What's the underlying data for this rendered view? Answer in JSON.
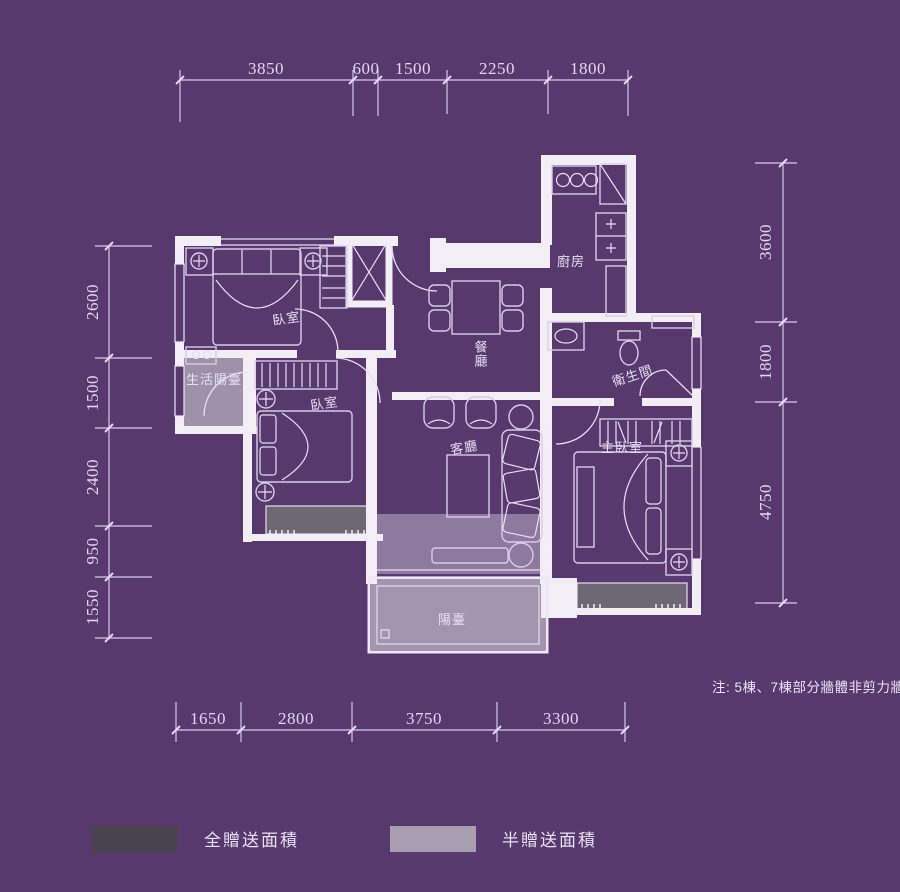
{
  "title": "apartment-floor-plan",
  "colors": {
    "background": "#57396e",
    "wall": "#f3eef6",
    "half_gift_fill": "#a89db1",
    "full_gift_fill": "#6e6874",
    "living_overlay": "rgba(198,188,208,0.5)",
    "dim_line": "#c3b2d8",
    "dim_text": "#e2d6f0"
  },
  "dimensions": {
    "top": [
      "3850",
      "600",
      "1500",
      "2250",
      "1800"
    ],
    "left": [
      "2600",
      "1500",
      "2400",
      "950",
      "1550"
    ],
    "right": [
      "3600",
      "1800",
      "4750"
    ],
    "bottom": [
      "1650",
      "2800",
      "3750",
      "3300"
    ]
  },
  "rooms": {
    "bedroom1": "臥室",
    "bedroom2": "臥室",
    "master_bedroom": "主臥室",
    "living_room": "客廳",
    "dining_room": "餐廳",
    "kitchen": "廚房",
    "bathroom": "衛生間",
    "service_balcony": "生活陽臺",
    "balcony": "陽臺"
  },
  "note": "注: 5棟、7棟部分牆體非剪力牆",
  "legend": {
    "items": [
      {
        "label": "全贈送面積",
        "color": "#494350"
      },
      {
        "label": "半贈送面積",
        "color": "#a89db1"
      }
    ]
  }
}
